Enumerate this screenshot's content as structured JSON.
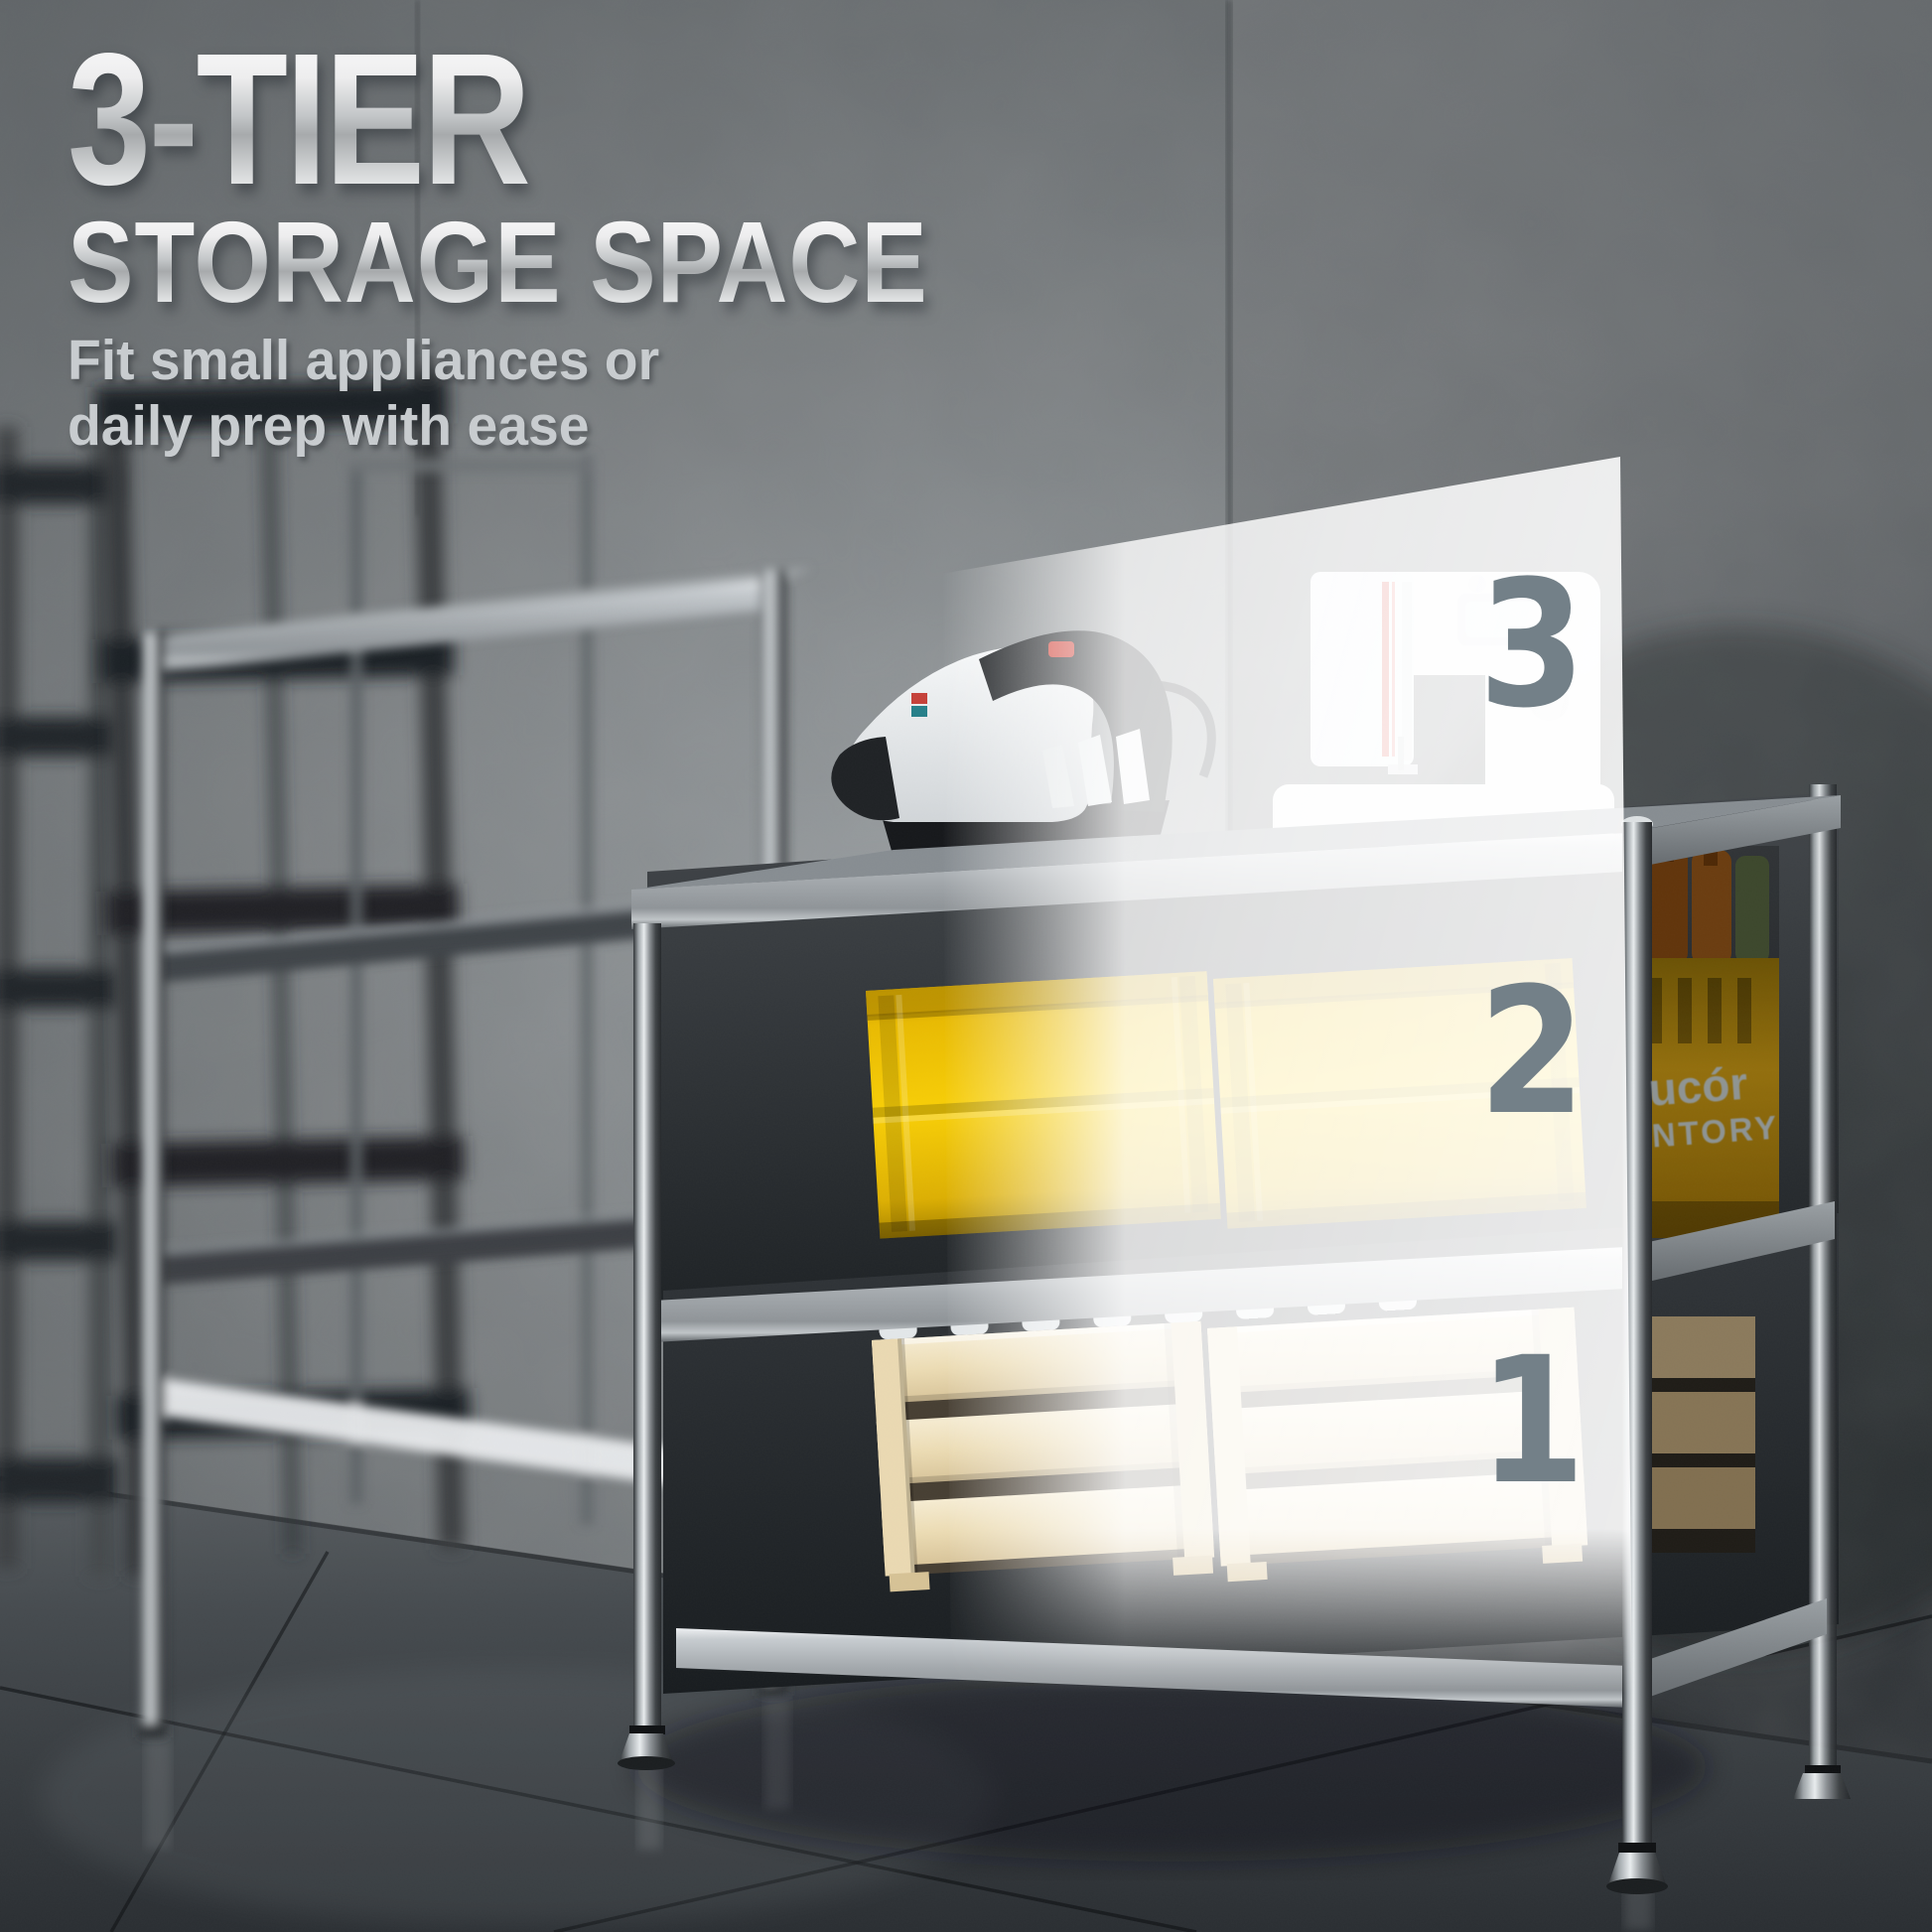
{
  "headline": {
    "line1": "3-TIER",
    "line2": "STORAGE SPACE"
  },
  "subtitle": {
    "line1": "Fit small appliances or",
    "line2": "daily prep with ease"
  },
  "tiers": {
    "top": "3",
    "middle": "2",
    "bottom": "1"
  },
  "crate_marking": {
    "line1": "ucór",
    "line2": "NTORY"
  },
  "colors": {
    "tier_number_gray": "#738088",
    "headline_silver": "#e8eaeb",
    "subtitle_gray": "#c8cccf",
    "crate_yellow": "#f5c800",
    "wood_tan": "#ecdcb4",
    "chrome_silver": "#c6cbce",
    "amber_crate": "#b8860b",
    "panel_white": "#ffffff",
    "wall_gray": "#9aa0a3",
    "floor_charcoal": "#34383c"
  }
}
